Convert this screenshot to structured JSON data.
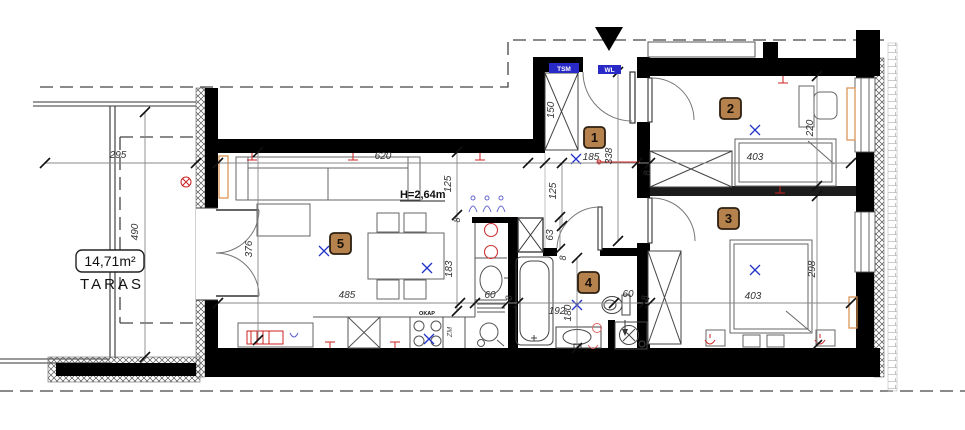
{
  "plan": {
    "terrace": {
      "area": "14,71m²",
      "name": "TARAS"
    },
    "labels": {
      "height_note": "H=2,64m",
      "tsm": "TSM",
      "wl": "WL",
      "okap": "OKAP",
      "zm": "ZM"
    },
    "rooms": {
      "r1": "1",
      "r2": "2",
      "r3": "3",
      "r4": "4",
      "r5": "5"
    },
    "dims": {
      "terrace_width": "295",
      "terrace_depth": "490",
      "living_width": "620",
      "living_depth": "376",
      "living_bottom": "485",
      "seg125_left": "125",
      "seg125_hall": "125",
      "wardrobe_depth": "150",
      "hall_width": "185",
      "hall_length": "338",
      "wall8_hall": "8",
      "room2_width": "403",
      "room2_depth": "220",
      "kitchen_run": "183",
      "kitchen_top8": "8",
      "shaft_height": "63",
      "shaft8": "8",
      "counter60": "60",
      "wall8_bath": "8",
      "bath_width": "192",
      "bath_depth": "180",
      "wc60": "60",
      "wall8_wc": "8",
      "room3_width": "403",
      "room3_depth": "298"
    },
    "colors": {
      "wall": "#000000",
      "badge": "#b5824e",
      "accent_blue": "#2929c8",
      "accent_red": "#cc2222",
      "radiator": "#d98e4a"
    }
  }
}
